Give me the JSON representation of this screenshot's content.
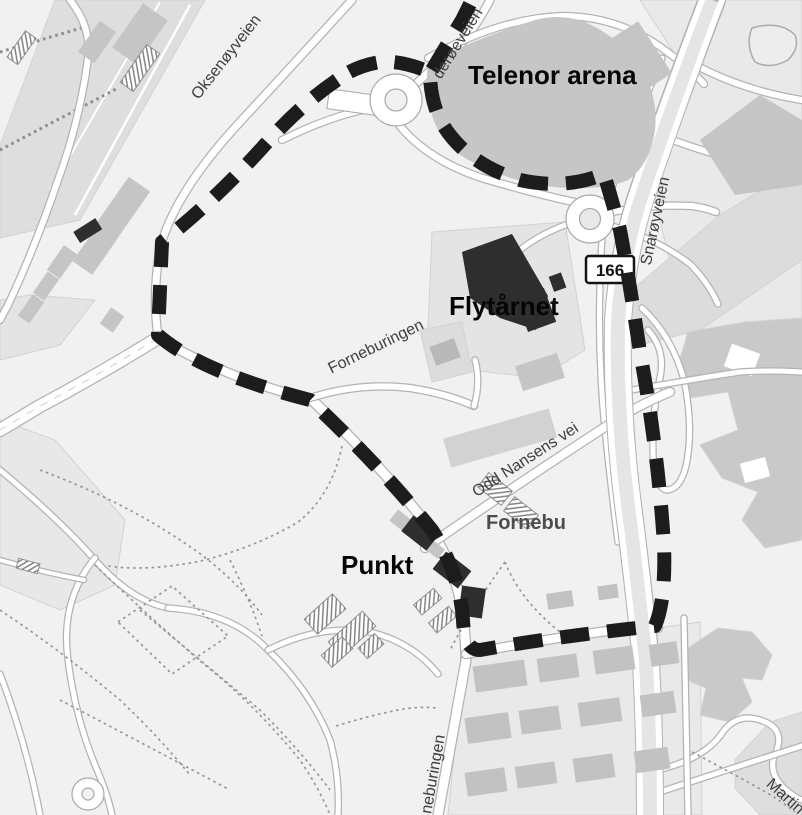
{
  "map": {
    "place_labels": {
      "telenor_arena": "Telenor arena",
      "flytarnet": "Flytårnet",
      "punkt": "Punkt",
      "fornebu": "Fornebu"
    },
    "road_labels": {
      "oksenoyveien": "Oksenøyveien",
      "wideroeveien": "derøeveien",
      "snaroyveien": "Snarøyveien",
      "forneburingen": "Forneburingen",
      "odd_nansens_vei": "Odd Nansens vei",
      "forneburingen_south": "neburingen",
      "martin": "Martin"
    },
    "route_badge": "166",
    "colors": {
      "background": "#f1f1f1",
      "route_dash": "#1c1c1c",
      "building": "#c5c5c5",
      "building_dark": "#2e2e2e",
      "road": "#ffffff",
      "label_primary": "#050505",
      "label_secondary": "#4d4d4d"
    }
  }
}
